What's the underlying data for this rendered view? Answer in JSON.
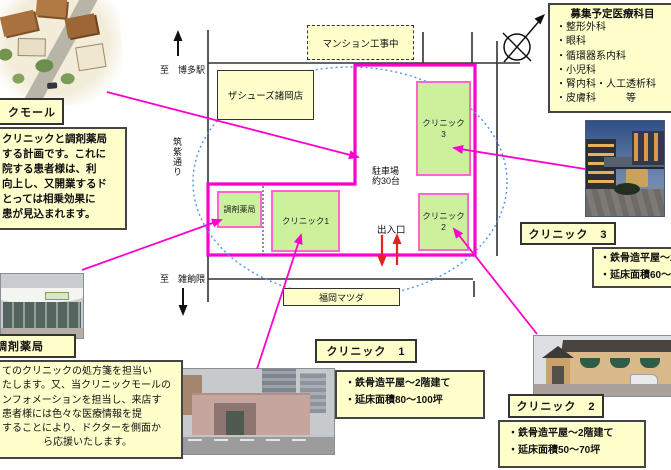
{
  "recruit": {
    "title": "募集予定医療科目",
    "items": [
      "・整形外科",
      "・眼科",
      "・循環器系内科",
      "・小児科",
      "・腎内科・人工透析科",
      "・皮膚科　　　等"
    ]
  },
  "mall": {
    "label": "クモール",
    "plan_lines": [
      "クリニックと調剤薬局",
      "する計画です。これに",
      "院する患者様は、利",
      "向上し、又開業するド",
      "とっては相乗効果に",
      "患が見込まれます。"
    ]
  },
  "map": {
    "construction": "マンション工事中",
    "shoes": "ザシューズ諸岡店",
    "mazda": "福岡マツダ",
    "to_hakata": "至　博多駅",
    "chikushi": "筑紫通り",
    "to_zasshonokuma": "至　雑餉隈",
    "parking_line1": "駐車場",
    "parking_line2": "約30台",
    "entrance": "出入口",
    "pharmacy": "調剤薬局",
    "clinic1": "クリニック1",
    "clinic2_line1": "クリニック",
    "clinic2_line2": "2",
    "clinic3_line1": "クリニック",
    "clinic3_line2": "3"
  },
  "pharmacy": {
    "label": "調剤薬局",
    "desc_lines": [
      "てのクリニックの処方箋を担当い",
      "たします。又、当クリニックモールの",
      "ンフォメーションを担当し、来店す",
      "患者様には色々な医療情報を提",
      "することにより、ドクターを側面か",
      "ら応援いたします。"
    ]
  },
  "clinic1": {
    "label": "クリニック　1",
    "specs": [
      "・鉄骨造平屋～2階建て",
      "・延床面積80～100坪"
    ]
  },
  "clinic2": {
    "label": "クリニック　2",
    "specs": [
      "・鉄骨造平屋～2階建て",
      "・延床面積50～70坪"
    ]
  },
  "clinic3": {
    "label": "クリニック　3",
    "specs": [
      "・鉄骨造平屋～2階建",
      "・延床面積60～70坪"
    ]
  },
  "colors": {
    "site_outline": "#FF00CC",
    "clinic_fill": "#CCF09C",
    "clinic_border": "#FF66CC",
    "note_yellow": "#FFFFCC",
    "catchment_blue": "#4D94E8",
    "entrance_red": "#E42222"
  }
}
